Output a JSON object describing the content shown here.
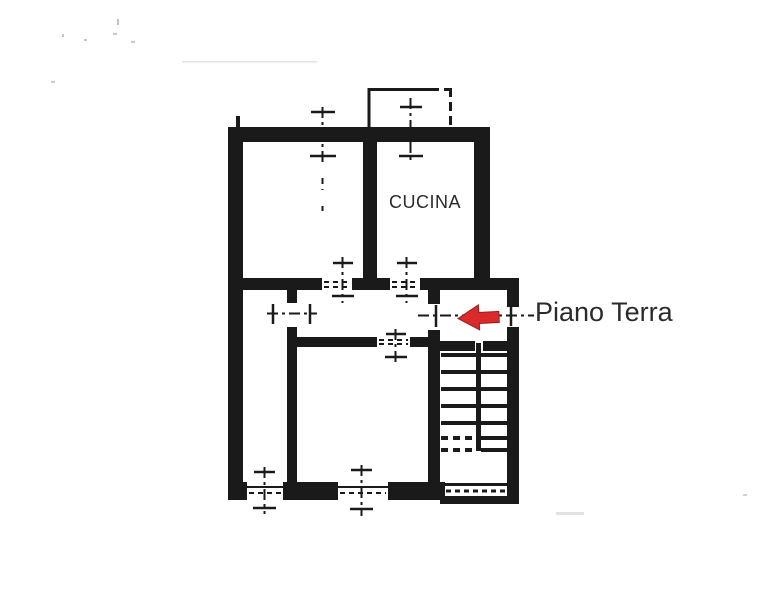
{
  "plan": {
    "kitchen_label": "CUCINA",
    "floor_label": "Piano Terra",
    "arrow": {
      "direction": "left",
      "color": "#d92b2b"
    },
    "colors": {
      "ink": "#1a1a1a",
      "label": "#2b2b2b",
      "arrow": "#d92b2b",
      "speck": "#8f8f8f"
    }
  }
}
